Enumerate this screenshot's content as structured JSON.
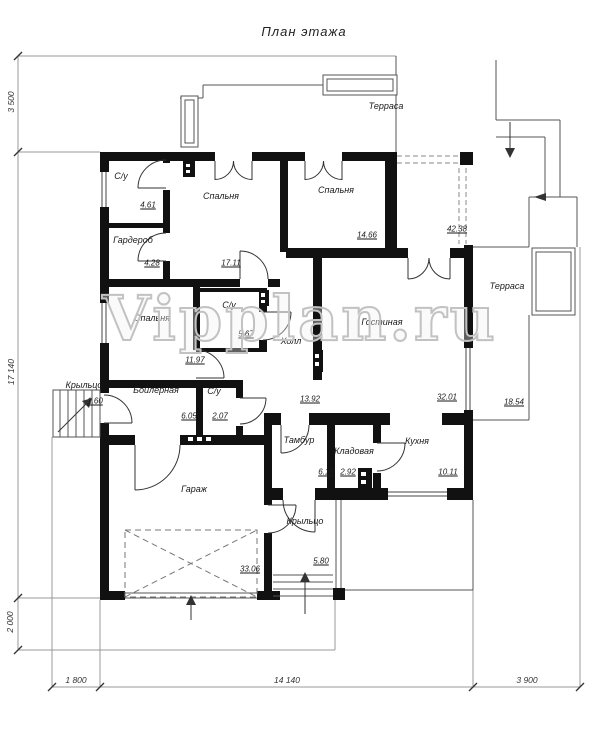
{
  "title": "План этажа",
  "watermark": "Vipplan.ru",
  "rooms": [
    {
      "label": "С/у",
      "area": "4.61"
    },
    {
      "label": "Спальня",
      "area": "17.11"
    },
    {
      "label": "Гардероб",
      "area": "4.28"
    },
    {
      "label": "Спальня",
      "area": "14.66"
    },
    {
      "label": "Терраса",
      "area": "42.38"
    },
    {
      "label": "Спальня",
      "area": "11.97"
    },
    {
      "label": "С/у",
      "area": "5.67"
    },
    {
      "label": "Холл",
      "area": "13.92"
    },
    {
      "label": "Гостиная",
      "area": "32.01"
    },
    {
      "label": "Терраса",
      "area": "18.54"
    },
    {
      "label": "Крыльцо",
      "area": "1.60"
    },
    {
      "label": "Бойлерная",
      "area": "6.05"
    },
    {
      "label": "С/у",
      "area": "2.07"
    },
    {
      "label": "Тамбур",
      "area": "6.18"
    },
    {
      "label": "Кладовая",
      "area": "2.92"
    },
    {
      "label": "Кухня",
      "area": "10.11"
    },
    {
      "label": "Гараж",
      "area": "33.06"
    },
    {
      "label": "Крыльцо",
      "area": "5.80"
    }
  ],
  "dimensions": {
    "left_top": "3 500",
    "left_mid": "17 140",
    "left_bottom": "2 000",
    "bottom_left": "1 800",
    "bottom_mid": "14 140",
    "bottom_right": "3 900"
  },
  "colors": {
    "wall": "#111111",
    "line": "#555555",
    "watermark": "#c2c2c2"
  }
}
